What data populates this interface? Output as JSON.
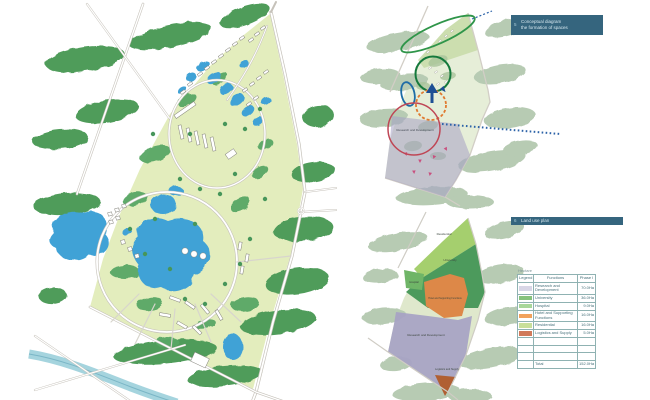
{
  "sheet": {
    "background": "#ffffff"
  },
  "sections": [
    {
      "number": "5",
      "title_line1": "Conceptual diagram",
      "title_line2": "the formation of spaces"
    },
    {
      "number": "6",
      "title_line1": "Land use plan"
    }
  ],
  "concept_diagram": {
    "zone_label": "Research and Development",
    "annotation_colors": {
      "cluster_band_green": "#2f9549",
      "core_circle_green": "#15793c",
      "axis_arrow_blue": "#1d4f94",
      "hospital_oval_blue": "#1e6ca6",
      "hotel_ring_orange": "#e07a30",
      "rnd_circle_red": "#bf4655",
      "rnd_area_purple": "#a5a1c5",
      "flow_arrows_pink": "#c94f7e",
      "link_dotted_blue": "#2c63a8"
    }
  },
  "land_use_plan": {
    "zones": [
      {
        "name": "Residential",
        "color": "#a5cf6e"
      },
      {
        "name": "University",
        "color": "#4c9a5c"
      },
      {
        "name": "Hospital",
        "color": "#6fb567"
      },
      {
        "name": "Hotel and Supporting Functions",
        "color": "#dd8848"
      },
      {
        "name": "Research and Development",
        "color": "#a6a2c4"
      },
      {
        "name": "Logistics and Supply",
        "color": "#b05f33"
      }
    ]
  },
  "legend_table": {
    "unit_note": "Hectare",
    "columns": [
      "Legend",
      "Functions",
      "Phase I"
    ],
    "rows": [
      {
        "color": "#d8d6e6",
        "function": "Research and Development",
        "value": "70.0Ha"
      },
      {
        "color": "#86c27c",
        "function": "University",
        "value": "36.0Ha"
      },
      {
        "color": "#a8d79a",
        "function": "Hospital",
        "value": "9.0Ha"
      },
      {
        "color": "#f2a25c",
        "function": "Hotel and Supporting Functions",
        "value": "16.0Ha"
      },
      {
        "color": "#c8df9a",
        "function": "Residential",
        "value": "16.0Ha"
      },
      {
        "color": "#d07a5a",
        "function": "Logistics and Supply",
        "value": "5.0Ha"
      },
      {
        "color": "",
        "function": "",
        "value": ""
      },
      {
        "color": "",
        "function": "",
        "value": ""
      },
      {
        "color": "",
        "function": "",
        "value": ""
      },
      {
        "color": "",
        "function": "Total",
        "value": "152.0Ha"
      }
    ]
  }
}
